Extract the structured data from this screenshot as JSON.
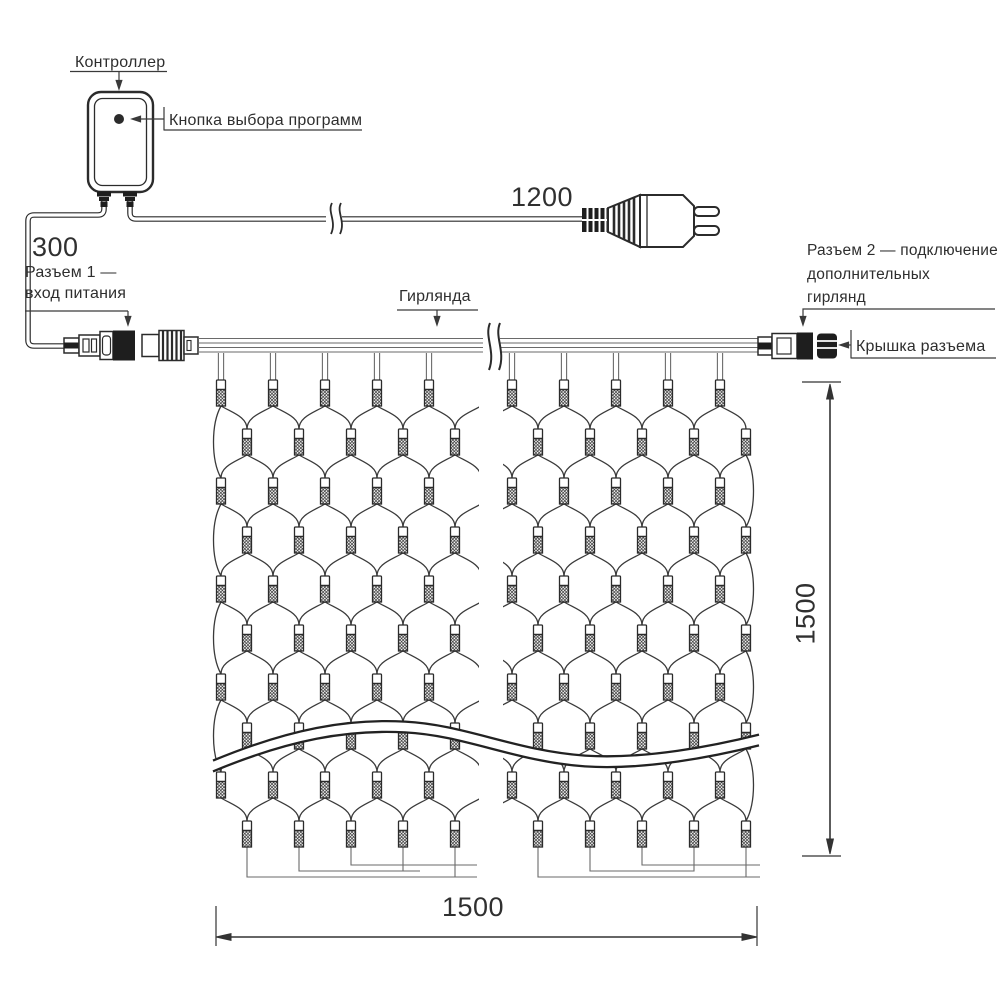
{
  "diagram": {
    "controller": {
      "label": "Контроллер",
      "button_label": "Кнопка выбора программ"
    },
    "power_cord": {
      "length": "1200"
    },
    "input_cord": {
      "length": "300"
    },
    "connector1": {
      "line1": "Разъем 1 —",
      "line2": "вход питания"
    },
    "garland": {
      "label": "Гирлянда"
    },
    "connector2": {
      "line1": "Разъем 2 — подключение",
      "line2": "дополнительных",
      "line3": "гирлянд"
    },
    "cap": {
      "label": "Крышка разъема"
    },
    "dimensions": {
      "net_width": "1500",
      "net_height": "1500"
    }
  },
  "colors": {
    "ink": "#2b2b2b",
    "net_wire": "#3a3a3a",
    "feed_wire": "#6a6a6a",
    "dark_fill": "#1e1e1e",
    "background": "#ffffff"
  }
}
